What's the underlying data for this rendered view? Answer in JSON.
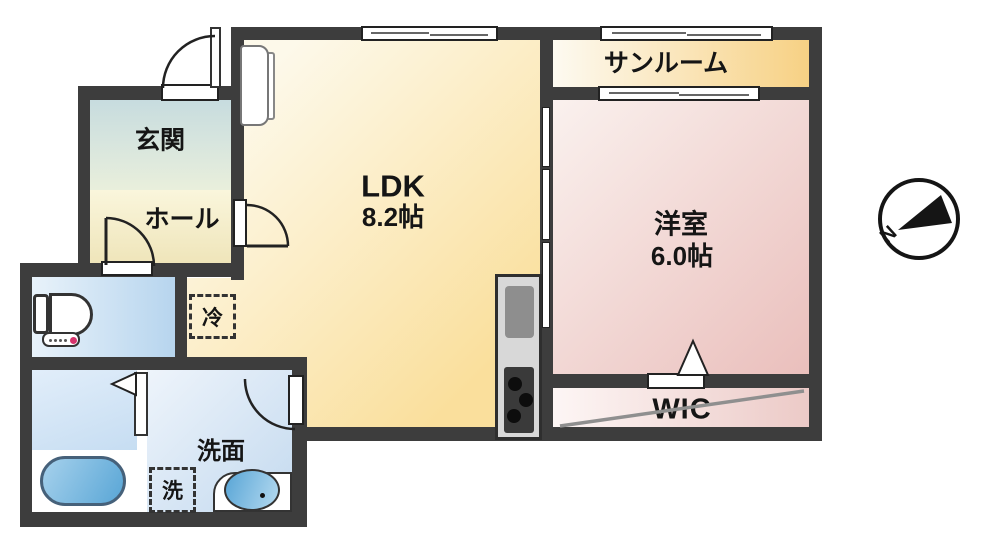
{
  "plan": {
    "type": "apartment-floor-plan",
    "rooms": {
      "genkan": {
        "label": "玄関"
      },
      "hall": {
        "label": "ホール"
      },
      "ldk": {
        "label": "LDK",
        "area": "8.2帖"
      },
      "sunroom": {
        "label": "サンルーム"
      },
      "bedroom": {
        "label": "洋室",
        "area": "6.0帖"
      },
      "wic": {
        "label": "WIC"
      },
      "washroom": {
        "label": "洗面"
      }
    },
    "fixtures": {
      "fridge": {
        "label": "冷"
      },
      "washer": {
        "label": "洗"
      }
    },
    "compass": {
      "label": "N"
    },
    "colors": {
      "wall": "#3d3d3d",
      "ldk_floor": "#fadf9c",
      "sunroom_floor": "#f7d184",
      "bedroom_floor": "#eabfbc",
      "wic_floor": "#eccac7",
      "genkan_floor": "#c7dcdf",
      "hall_floor": "#f5eecb",
      "wet_area_floor": "#b7d5ee",
      "bathtub": "#59a6d6",
      "kitchen_unit": "#d8d8d8"
    }
  }
}
